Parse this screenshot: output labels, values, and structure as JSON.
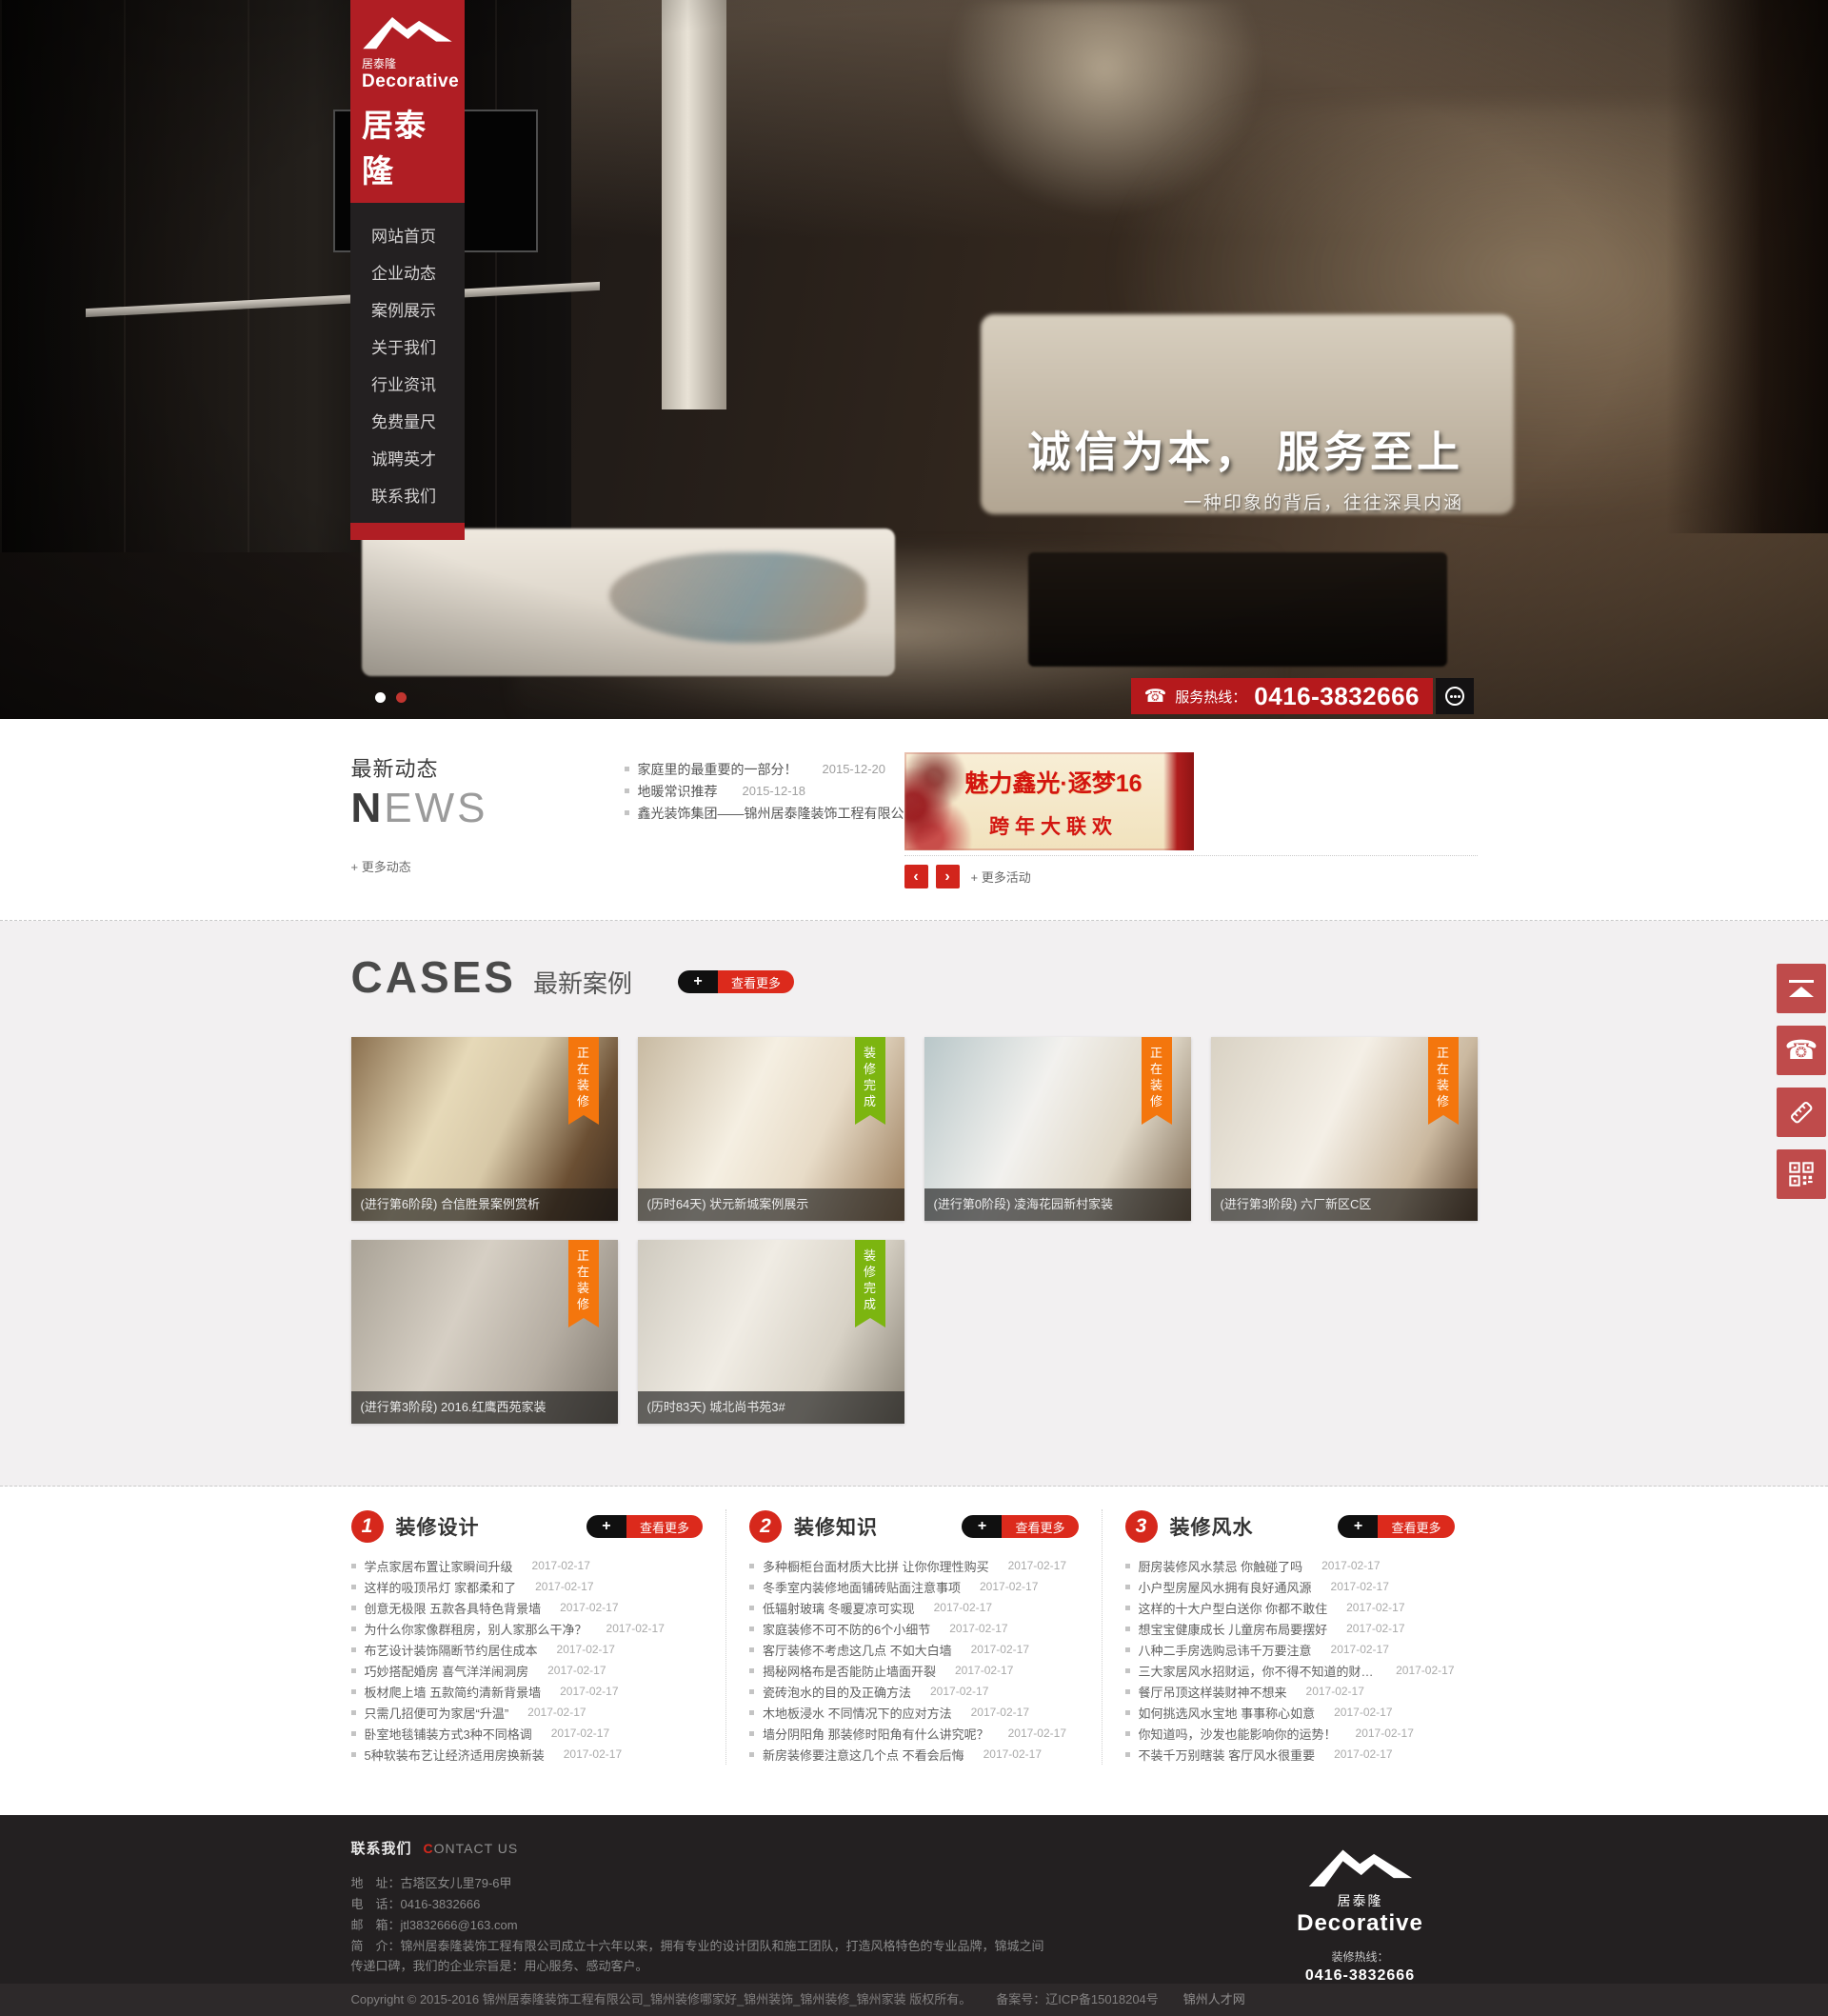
{
  "brand": {
    "logo_text_small": "居泰隆",
    "logo_text_en": "Decorative",
    "logo_text_large": "居泰隆"
  },
  "colors": {
    "brand_red": "#b01e24",
    "accent_red": "#d6281c",
    "ribbon_orange": "#f4760d",
    "ribbon_green": "#7cb510",
    "float_button_red": "#bf4b4b"
  },
  "nav": {
    "items": [
      {
        "label": "网站首页"
      },
      {
        "label": "企业动态"
      },
      {
        "label": "案例展示"
      },
      {
        "label": "关于我们"
      },
      {
        "label": "行业资讯"
      },
      {
        "label": "免费量尺"
      },
      {
        "label": "诚聘英才"
      },
      {
        "label": "联系我们"
      }
    ]
  },
  "hero": {
    "slogan": "诚信为本， 服务至上",
    "slogan_sub": "一种印象的背后，往往深具内涵",
    "hotline_label": "服务热线：",
    "hotline_number": "0416-3832666"
  },
  "news": {
    "title_cn": "最新动态",
    "title_en_bold": "N",
    "title_en_light": "EWS",
    "items": [
      {
        "title": "家庭里的最重要的一部分！",
        "date": "2015-12-20"
      },
      {
        "title": "地暖常识推荐",
        "date": "2015-12-18"
      },
      {
        "title": "鑫光装饰集团——锦州居泰隆装饰工程有限公司",
        "date": "2015-12-16"
      }
    ],
    "more_label": "+ 更多动态",
    "banner": {
      "line1": "魅力鑫光·逐梦16",
      "line2": "跨年大联欢"
    },
    "prev": "‹",
    "next": "›",
    "more_activity": "+ 更多活动"
  },
  "cases": {
    "title": "CASES",
    "subtitle": "最新案例",
    "view_more_plus": "+",
    "view_more_label": "查看更多",
    "cards": [
      {
        "caption": "(进行第6阶段) 合信胜景案例赏析",
        "ribbon": "正在装修"
      },
      {
        "caption": "(历时64天) 状元新城案例展示",
        "ribbon": "装修完成"
      },
      {
        "caption": "(进行第0阶段) 凌海花园新村家装",
        "ribbon": "正在装修"
      },
      {
        "caption": "(进行第3阶段) 六厂新区C区",
        "ribbon": "正在装修"
      },
      {
        "caption": "(进行第3阶段) 2016.红鹰西苑家装",
        "ribbon": "正在装修"
      },
      {
        "caption": "(历时83天) 城北尚书苑3#",
        "ribbon": "装修完成"
      }
    ]
  },
  "articles": {
    "view_more_plus": "+",
    "view_more_label": "查看更多",
    "columns": [
      {
        "num": "1",
        "title": "装修设计",
        "items": [
          {
            "title": "学点家居布置让家瞬间升级",
            "date": "2017-02-17"
          },
          {
            "title": "这样的吸顶吊灯 家都柔和了",
            "date": "2017-02-17"
          },
          {
            "title": "创意无极限 五款各具特色背景墙",
            "date": "2017-02-17"
          },
          {
            "title": "为什么你家像群租房，别人家那么干净？",
            "date": "2017-02-17"
          },
          {
            "title": "布艺设计装饰隔断节约居住成本",
            "date": "2017-02-17"
          },
          {
            "title": "巧妙搭配婚房 喜气洋洋闹洞房",
            "date": "2017-02-17"
          },
          {
            "title": "板材爬上墙 五款简约清新背景墙",
            "date": "2017-02-17"
          },
          {
            "title": "只需几招便可为家居“升温”",
            "date": "2017-02-17"
          },
          {
            "title": "卧室地毯铺装方式3种不同格调",
            "date": "2017-02-17"
          },
          {
            "title": "5种软装布艺让经济适用房换新装",
            "date": "2017-02-17"
          }
        ]
      },
      {
        "num": "2",
        "title": "装修知识",
        "items": [
          {
            "title": "多种橱柜台面材质大比拼 让你你理性购买",
            "date": "2017-02-17"
          },
          {
            "title": "冬季室内装修地面铺砖贴面注意事项",
            "date": "2017-02-17"
          },
          {
            "title": "低辐射玻璃 冬暖夏凉可实现",
            "date": "2017-02-17"
          },
          {
            "title": "家庭装修不可不防的6个小细节",
            "date": "2017-02-17"
          },
          {
            "title": "客厅装修不考虑这几点 不如大白墙",
            "date": "2017-02-17"
          },
          {
            "title": "揭秘网格布是否能防止墙面开裂",
            "date": "2017-02-17"
          },
          {
            "title": "瓷砖泡水的目的及正确方法",
            "date": "2017-02-17"
          },
          {
            "title": "木地板浸水 不同情况下的应对方法",
            "date": "2017-02-17"
          },
          {
            "title": "墙分阴阳角 那装修时阳角有什么讲究呢？",
            "date": "2017-02-17"
          },
          {
            "title": "新房装修要注意这几个点 不看会后悔",
            "date": "2017-02-17"
          }
        ]
      },
      {
        "num": "3",
        "title": "装修风水",
        "items": [
          {
            "title": "厨房装修风水禁忌 你触碰了吗",
            "date": "2017-02-17"
          },
          {
            "title": "小户型房屋风水拥有良好通风源",
            "date": "2017-02-17"
          },
          {
            "title": "这样的十大户型白送你 你都不敢住",
            "date": "2017-02-17"
          },
          {
            "title": "想宝宝健康成长 儿童房布局要摆好",
            "date": "2017-02-17"
          },
          {
            "title": "八种二手房选购忌讳千万要注意",
            "date": "2017-02-17"
          },
          {
            "title": "三大家居风水招财运，你不得不知道的财源广进",
            "date": "2017-02-17"
          },
          {
            "title": "餐厅吊顶这样装财神不想来",
            "date": "2017-02-17"
          },
          {
            "title": "如何挑选风水宝地 事事称心如意",
            "date": "2017-02-17"
          },
          {
            "title": "你知道吗，沙发也能影响你的运势！",
            "date": "2017-02-17"
          },
          {
            "title": "不装千万别瞎装 客厅风水很重要",
            "date": "2017-02-17"
          }
        ]
      }
    ]
  },
  "footer": {
    "contact_cn": "联系我们",
    "contact_en_c": "C",
    "contact_en_rest": "ONTACT US",
    "rows": [
      {
        "label": "地　址：",
        "value": "古塔区女儿里79-6甲"
      },
      {
        "label": "电　话：",
        "value": "0416-3832666"
      },
      {
        "label": "邮　箱：",
        "value": "jtl3832666@163.com"
      },
      {
        "label": "简　介：",
        "value": "锦州居泰隆装饰工程有限公司成立十六年以来，拥有专业的设计团队和施工团队，打造风格特色的专业品牌，锦城之间传递口碑，我们的企业宗旨是：用心服务、感动客户。"
      }
    ],
    "logo_cn": "居泰隆",
    "logo_en": "Decorative",
    "hotline_label": "装修热线：",
    "hotline_number": "0416-3832666"
  },
  "copyright": {
    "main": "Copyright © 2015-2016 锦州居泰隆装饰工程有限公司_锦州装修哪家好_锦州装饰_锦州装修_锦州家装 版权所有。",
    "beian": "备案号：辽ICP备15018204号",
    "link": "锦州人才网"
  }
}
